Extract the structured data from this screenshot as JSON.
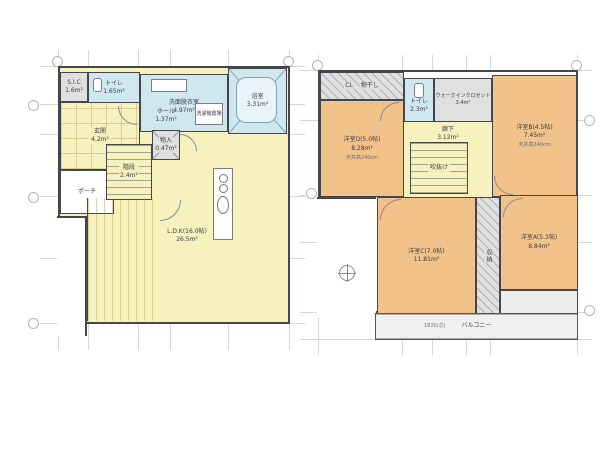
{
  "floor1": {
    "rooms": {
      "sic": "S.I.C\n1.6m²",
      "toilet": "トイレ\n1.65m²",
      "washroom": "洗面脱衣室\n4.97m²",
      "laundry": "洗濯機置場",
      "bath": "浴室\n3.31m²",
      "genkan": "玄関\n4.2m²",
      "hall": "ホール\n1.37m²",
      "stairs": "階段\n2.4m²",
      "storage": "物入\n0.47m²",
      "ldk": "L.D.K(16.0帖)\n26.5m²",
      "porch": "ポーチ"
    }
  },
  "floor2": {
    "rooms": {
      "closet": "CL",
      "drying": "物干し",
      "bedroom_d": "洋室D(5.0帖)\n8.28m²",
      "bedroom_d_note": "天井高240cm",
      "toilet": "トイレ\n2.3m²",
      "wic": "ウォークインクロゼット\n3.4m²",
      "bedroom_b": "洋室B(4.5帖)\n7.45m²",
      "bedroom_b_note": "天井高240cm",
      "hall": "廊下\n3.12m²",
      "void": "吹抜け",
      "bedroom_c": "洋室C(7.0帖)\n11.81m²",
      "closet_center": "収納",
      "bedroom_a": "洋室A(5.3帖)\n8.84m²",
      "balcony": "バルコニー",
      "balcony_dim": "1820(芯)"
    }
  },
  "colors": {
    "floor_yellow": "#f6f1bd",
    "wet_blue": "#cfe7ef",
    "bedroom_orange": "#f1c289",
    "closet_gray": "#e0e0e0",
    "wall": "#45454c"
  }
}
